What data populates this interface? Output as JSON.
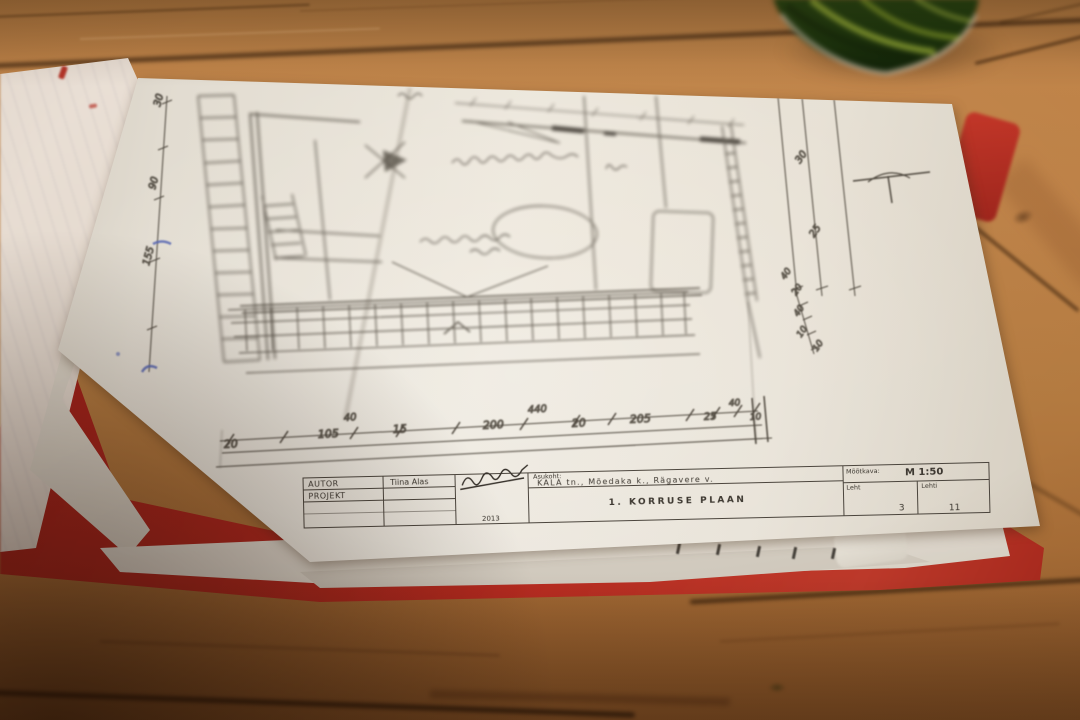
{
  "scene": {
    "description": "Photograph of a hand-drawn architectural floor plan (1st floor plan, scale 1:50) lying with other sheets in a red folder on a wooden slat table; blurred green cup at top edge",
    "objects": [
      "wooden-table",
      "green-cup",
      "red-folder",
      "white-notebook-stack",
      "floor-plan-sheet",
      "under-sheets"
    ]
  },
  "colors": {
    "wood_light": "#c08449",
    "wood_dark": "#5f3a1c",
    "wood_gap": "#3a2008",
    "paper": "#ece7dd",
    "folder_red": "#b92b20",
    "cup_green": "#1e3a10",
    "cup_leaf": "#a7bf3c",
    "pencil": "#4a443b",
    "blue_ink": "#5565b2"
  },
  "title_block": {
    "autor_label": "AUTOR",
    "projekt_label": "PROJEKT",
    "author_name": "Tiina Alas",
    "year": "2013",
    "asukoht_label": "Asukoht:",
    "address": "KALA tn., Mõedaka k., Rägavere v.",
    "drawing_title": "1. KORRUSE PLAAN",
    "scale_label": "Mõõtkava:",
    "scale_value": "M 1:50",
    "leht_label": "Leht",
    "leht_value": "3",
    "lehti_label": "Lehti",
    "lehti_value": "11"
  },
  "dims": {
    "left": [
      "30",
      "90",
      "155"
    ],
    "bottom": [
      "20",
      "40",
      "105",
      "15",
      "200",
      "440",
      "20",
      "205",
      "25",
      "40",
      "10"
    ],
    "right": [
      "30",
      "25",
      "40",
      "20",
      "40",
      "10",
      "10"
    ]
  }
}
